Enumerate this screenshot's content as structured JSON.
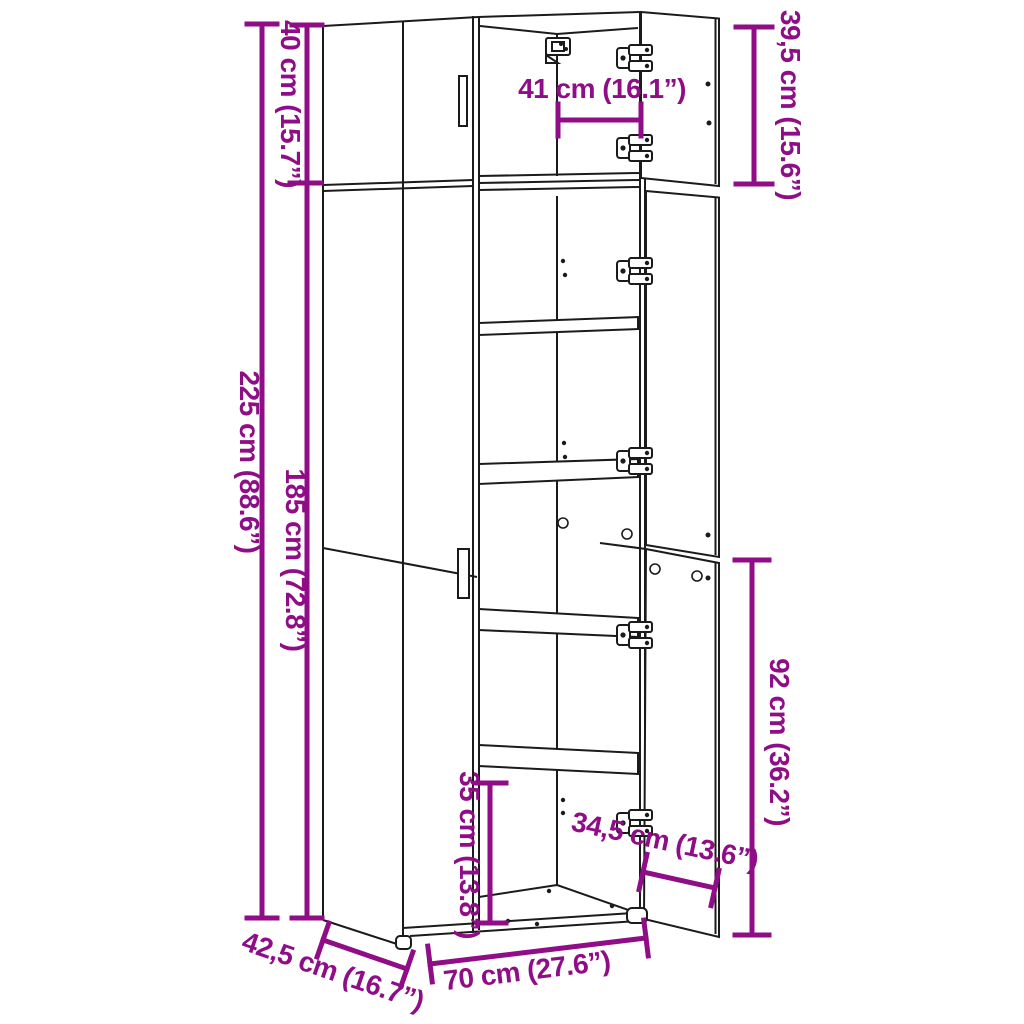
{
  "figure": {
    "type": "product-dimension-diagram",
    "subject": "tall two-section cabinet with open right doors, interior shelves and hinges",
    "background_color": "#ffffff",
    "outline_color": "#1b1b1b",
    "dimension_color": "#8F0D86"
  },
  "dimensions": {
    "total_height": {
      "label": "225 cm (88.6”)",
      "orientation": "vertical-left"
    },
    "top_section_height": {
      "label": "40 cm (15.7”)",
      "orientation": "vertical-left"
    },
    "lower_section_height": {
      "label": "185 cm (72.8”)",
      "orientation": "vertical-left"
    },
    "top_door_height": {
      "label": "39,5 cm (15.6”)",
      "orientation": "vertical-right"
    },
    "interior_width": {
      "label": "41 cm (16.1”)",
      "orientation": "horizontal"
    },
    "lower_door_height": {
      "label": "92 cm (36.2”)",
      "orientation": "vertical-right"
    },
    "bottom_compartment_height": {
      "label": "35 cm (13.8”)",
      "orientation": "vertical-inside"
    },
    "door_width": {
      "label": "34,5 cm (13.6”)",
      "orientation": "diagonal"
    },
    "cabinet_width": {
      "label": "70 cm (27.6”)",
      "orientation": "bottom-front"
    },
    "cabinet_depth": {
      "label": "42,5 cm (16.7”)",
      "orientation": "bottom-side"
    }
  }
}
